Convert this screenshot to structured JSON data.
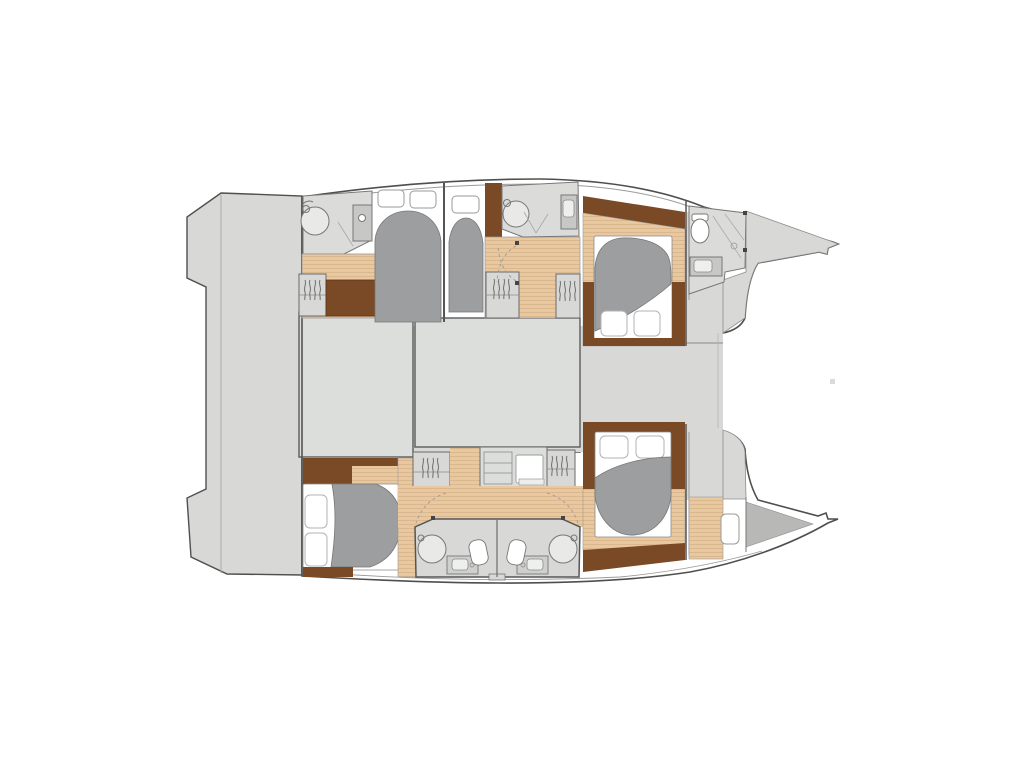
{
  "meta": {
    "title": "Catamaran interior layout floor plan (top view, bow to the right)",
    "image_type": "boat accommodation plan diagram",
    "visible_text": "none"
  },
  "palette": {
    "page_bg": "#ffffff",
    "deck": "#d8d9d7",
    "panel": "#dcdedc",
    "outline": "#4f4f4f",
    "wall": "#6e6e6e",
    "line": "#9a9a9a",
    "wood": "#e9c8a0",
    "wood_stripe": "#d9b78f",
    "wood_dark": "#7a4a26",
    "bed": "#9d9ea0",
    "bath": "#dbdcda",
    "fixture": "#c7c8c6",
    "shower": "#e9eae8",
    "white": "#ffffff",
    "wedge": "#b8b9b7",
    "post": "#444444"
  },
  "vessel": {
    "orientation": "bow-right",
    "aft_platform": "transom steps platform (left)",
    "bridgedeck_blocks": 2,
    "port_hull": {
      "position": "top",
      "cabins": [
        {
          "name": "aft double cabin",
          "bed": "double island bed"
        },
        {
          "name": "mid single cabin",
          "bed": "single berth"
        },
        {
          "name": "forward double cabin",
          "bed": "double island bed with pillows"
        }
      ],
      "bathrooms": [
        "aft shower room with sink",
        "mid shower room with vanity",
        "forward head with toilet, shower and sink"
      ]
    },
    "starboard_hull": {
      "position": "bottom",
      "cabins": [
        {
          "name": "aft double cabin",
          "bed": "double island bed with pillows"
        },
        {
          "name": "forward double cabin",
          "bed": "double island bed with pillows"
        }
      ],
      "bathrooms": [
        "twin mirrored shower rooms amidships, each with shower, sink and toilet"
      ],
      "forepeak": "bow storage / crew area with hatch"
    },
    "furniture": [
      "hanging wardrobes",
      "chest of drawers",
      "desk unit with drawers",
      "round showers",
      "sinks",
      "toilets",
      "island beds with gray duvets and white pillows"
    ]
  }
}
